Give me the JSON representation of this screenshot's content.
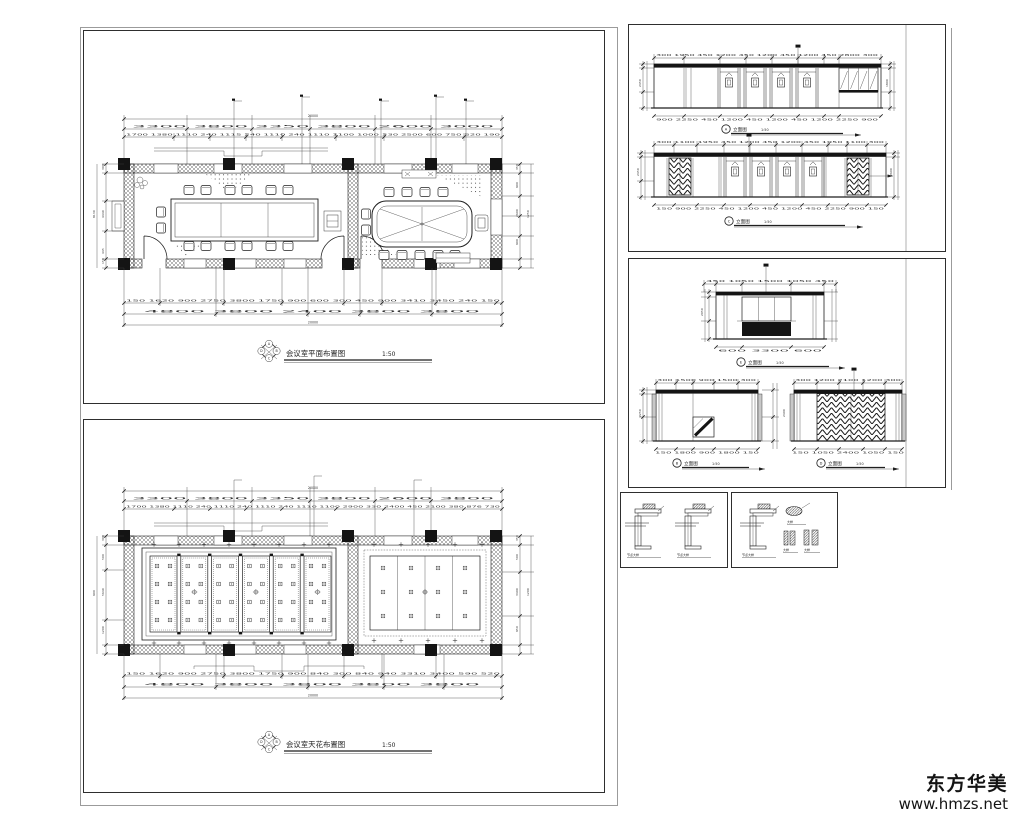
{
  "watermark": {
    "brand": "东方华美",
    "url": "www.hmzs.net"
  },
  "plan": {
    "title": "会议室平面布置图",
    "scale": "1:50",
    "marker": {
      "top": "A",
      "right": "B",
      "bottom": "C",
      "left": "D"
    },
    "dims": {
      "overall_top": "20000",
      "top_row1": "3300 3800 3350 3800 2600 3000",
      "top_row2": "1700 1380 1110 240 1115 240 1110 240 1110 1100 1000 330 2500 600 750 520 190",
      "bottom_row1": "150 1620 900 2750 3800 1750 900 600 300 450 900 3410 3450 240 150",
      "bottom_row2": "4800 3800 2400 3800 3800",
      "overall_bottom": "20000",
      "left": [
        "300",
        "4440",
        "8130",
        "445",
        "150"
      ],
      "right": [
        "350",
        "500",
        "900",
        "2600",
        "900",
        "1250",
        "150"
      ]
    }
  },
  "ceiling": {
    "title": "会议室天花布置图",
    "scale": "1:50",
    "marker": {
      "top": "A",
      "right": "B",
      "bottom": "C",
      "left": "D"
    },
    "dims": {
      "overall_top": "20000",
      "top_row1": "3300 3800 3350 3800 2600 3800",
      "top_row2": "1700 1380 1110 240 1110 240 1110 240 1110 1100 2900 330 2400 450 2100 380 876 730",
      "bottom_row1": "150 1620 900 2750 3800 1750 900 840 300 840 940 3310 3400 590 520",
      "bottom_row2": "4800 3800 3800 3800 3800",
      "overall_bottom": "20000",
      "left": [
        "900",
        "300",
        "500",
        "5640",
        "1200",
        "450"
      ],
      "right": [
        "350",
        "100",
        "500",
        "3400",
        "950",
        "1200",
        "300"
      ]
    }
  },
  "elev": {
    "a": {
      "letter": "A",
      "title": "立面图",
      "scale": "1:50",
      "top": "300 1950 450 1200 450 1200 450 1200 450 2800 300",
      "bottom": "900 2250 450 1200 450 1200 450 1200 2250 900",
      "side": [
        "400",
        "2450",
        "150"
      ],
      "side_r": [
        "650",
        "1800",
        "550"
      ]
    },
    "c": {
      "letter": "C",
      "title": "立面图",
      "scale": "1:50",
      "top": "300 1100 1950 450 1200 450 1200 450 1950 1100 300",
      "bottom": "150 900 2250 450 1200 450 1200 450 2250 900 150",
      "side": [
        "400",
        "2450",
        "150"
      ],
      "side_r": [
        "2600",
        "400"
      ]
    },
    "e": {
      "letter": "E",
      "title": "立面图",
      "scale": "1:50",
      "top": "450 1050 1500 1050 450",
      "bottom": "600 3300 600",
      "side": [
        "400",
        "2050",
        "600"
      ]
    },
    "b": {
      "letter": "B",
      "title": "立面图",
      "scale": "1:50",
      "top": "300 1500 900 1500 300",
      "bottom": "150 1800 900 1800 150",
      "side": [
        "400",
        "2250",
        "150"
      ]
    },
    "d": {
      "letter": "D",
      "title": "立面图",
      "scale": "1:50",
      "top": "300 1200 2100 1200 300",
      "bottom": "150 1050 2400 1050 150",
      "side": [
        "2400",
        "400"
      ]
    }
  },
  "details": {
    "captions": [
      "节点大样",
      "节点大样",
      "节点大样"
    ],
    "minis": [
      "大样",
      "大样",
      "大样"
    ]
  }
}
